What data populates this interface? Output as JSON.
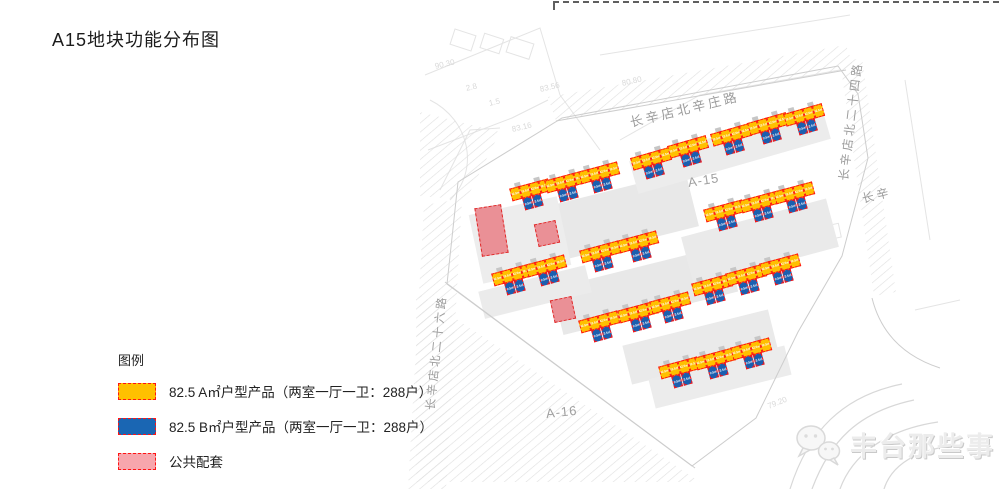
{
  "title": "A15地块功能分布图",
  "legend": {
    "heading": "图例",
    "swatch_border": "#ff1414",
    "items": [
      {
        "label": "82.5 A㎡户型产品（两室一厅一卫：288户）",
        "color": "#ffc000"
      },
      {
        "label": "82.5 B㎡户型产品（两室一厅一卫：288户）",
        "color": "#1a66b3"
      },
      {
        "label": "公共配套",
        "color": "#f7a6ad"
      }
    ]
  },
  "map": {
    "unit_label": "82.5㎡",
    "colors": {
      "unit_a": "#ffc000",
      "unit_b": "#1a5fb0",
      "public": "#ea9096",
      "outline": "#ff1414",
      "pub_outline": "#e02a2a",
      "core": "#c6c6c6"
    },
    "road_labels": [
      {
        "text": "长辛店北辛庄路",
        "x": 630,
        "y": 112,
        "r": -13.5,
        "size": 13
      },
      {
        "text": "长辛店北二十四路",
        "x": 843,
        "y": 172,
        "r": -83,
        "size": 12
      },
      {
        "text": "长辛店北二十六路",
        "x": 430,
        "y": 402,
        "r": -84,
        "size": 11.5
      },
      {
        "text": "长辛",
        "x": 862,
        "y": 190,
        "r": -14,
        "size": 12
      }
    ],
    "area_labels": [
      {
        "text": "A-15",
        "x": 688,
        "y": 175,
        "r": -9
      },
      {
        "text": "A-16",
        "x": 546,
        "y": 406,
        "r": -6
      }
    ],
    "elevation_labels": [
      {
        "text": "90.30",
        "x": 435,
        "y": 62,
        "r": -13
      },
      {
        "text": "83.56",
        "x": 540,
        "y": 85,
        "r": -13
      },
      {
        "text": "83.16",
        "x": 512,
        "y": 125,
        "r": -13
      },
      {
        "text": "80.80",
        "x": 622,
        "y": 79,
        "r": -13
      },
      {
        "text": "79.20",
        "x": 768,
        "y": 402,
        "r": -22
      },
      {
        "text": "2.8",
        "x": 466,
        "y": 84,
        "r": -13
      },
      {
        "text": "1.5",
        "x": 489,
        "y": 99,
        "r": -13
      }
    ],
    "buildings": [
      {
        "x": 653,
        "y": 165,
        "r": -16
      },
      {
        "x": 690,
        "y": 153,
        "r": -16
      },
      {
        "x": 733,
        "y": 141,
        "r": -16
      },
      {
        "x": 770,
        "y": 130,
        "r": -16
      },
      {
        "x": 806,
        "y": 121,
        "r": -16
      },
      {
        "x": 532,
        "y": 196,
        "r": -15
      },
      {
        "x": 567,
        "y": 188,
        "r": -15
      },
      {
        "x": 601,
        "y": 179,
        "r": -15
      },
      {
        "x": 726,
        "y": 217,
        "r": -15
      },
      {
        "x": 762,
        "y": 208,
        "r": -15
      },
      {
        "x": 796,
        "y": 199,
        "r": -15
      },
      {
        "x": 514,
        "y": 281,
        "r": -15
      },
      {
        "x": 548,
        "y": 272,
        "r": -15
      },
      {
        "x": 602,
        "y": 258,
        "r": -15
      },
      {
        "x": 640,
        "y": 248,
        "r": -15
      },
      {
        "x": 601,
        "y": 328,
        "r": -15
      },
      {
        "x": 640,
        "y": 318,
        "r": -15
      },
      {
        "x": 672,
        "y": 309,
        "r": -15
      },
      {
        "x": 714,
        "y": 291,
        "r": -15
      },
      {
        "x": 748,
        "y": 281,
        "r": -15
      },
      {
        "x": 782,
        "y": 271,
        "r": -15
      },
      {
        "x": 681,
        "y": 374,
        "r": -15
      },
      {
        "x": 717,
        "y": 365,
        "r": -15
      },
      {
        "x": 753,
        "y": 355,
        "r": -15
      }
    ],
    "public_blocks": [
      {
        "x": 478,
        "y": 206,
        "w": 27,
        "h": 49,
        "r": -9
      },
      {
        "x": 536,
        "y": 222,
        "w": 22,
        "h": 23,
        "r": -12
      },
      {
        "x": 552,
        "y": 298,
        "w": 22,
        "h": 23,
        "r": -12
      }
    ]
  },
  "watermark": {
    "text": "丰台那些事"
  }
}
